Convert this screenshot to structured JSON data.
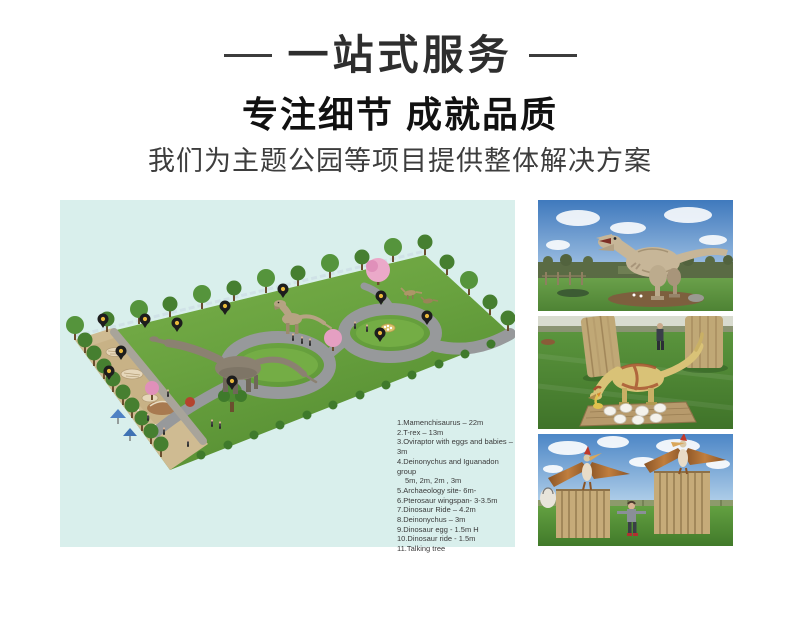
{
  "header": {
    "title": "一站式服务",
    "heading": "专注细节 成就品质",
    "subheading": "我们为主题公园等项目提供整体解决方案"
  },
  "plan": {
    "background_color": "#d9efec",
    "path_color": "#97999b",
    "grass_color": "#6aa544",
    "sand_color": "#cfbb92",
    "pin_color": "#1d1d1d",
    "pin_dot_color": "#e8b83a",
    "pin_count": 11,
    "legend": [
      "1.Mamenchisaurus – 22m",
      "2.T-rex – 13m",
      "3.Oviraptor with eggs and babies – 3m",
      "4.Deinonychus and Iguanadon group",
      "5m, 2m, 2m , 3m",
      "5.Archaeology site- 6m-",
      "6.Pterosaur  wingspan- 3-3.5m",
      "7.Dinosaur Ride – 4.2m",
      "8.Deinonychus – 3m",
      "9.Dinosaur egg - 1.5m H",
      "10.Dinosaur ride -  1.5m",
      "11.Talking tree"
    ]
  },
  "photos": {
    "items": [
      {
        "name": "t-rex-park-photo"
      },
      {
        "name": "oviraptor-nest-photo"
      },
      {
        "name": "pterosaur-posts-photo"
      }
    ],
    "sky_color": "#4c86c6",
    "grass_color": "#5f9a40",
    "wood_color": "#c6ab79"
  }
}
